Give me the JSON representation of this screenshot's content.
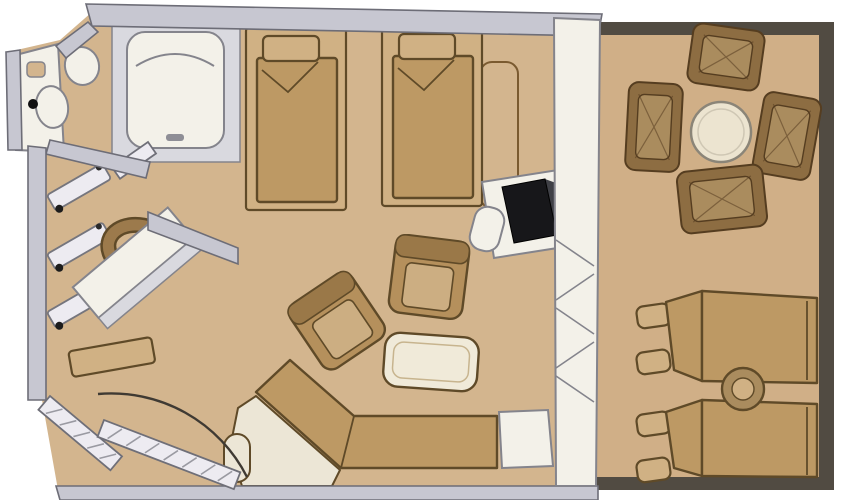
{
  "scene": {
    "type": "floor-plan",
    "title": "Suite stateroom floor plan with private balcony",
    "has_visible_text": false
  },
  "colors": {
    "background": "#ffffff",
    "floor": "#d3b58e",
    "balconyFloor": "#d0af87",
    "balconyEdge": "#514b42",
    "wall": "#c7c7d1",
    "wallEdge": "#6d6d77",
    "fixture": "#f3f1e9",
    "fixtureShade": "#d9d9df",
    "fixtureEdge": "#84848c",
    "furniture": "#bd9964",
    "furnitureLight": "#d0b184",
    "furnitureDark": "#5f4a28",
    "cream": "#ece6d6",
    "wicker": "#8d6d42",
    "wickerLight": "#aa8c5e",
    "wickerDark": "#553d20",
    "tv": "#17171a",
    "tvSide": "#3f4046",
    "doorArc": "#3f3a33",
    "consoleEdge": "#7a5a30",
    "tableTop": "#ece4d0",
    "tableEdge": "#8b8578"
  },
  "rooms": {
    "bathroom": {
      "name": "bathroom",
      "fixtures": [
        "bathtub",
        "toilet",
        "washbasin",
        "vanity-counter",
        "open-door"
      ]
    },
    "dressing_area": {
      "name": "dressing-area",
      "fixtures": [
        "closet-hangers",
        "dressing-table",
        "bench",
        "chair"
      ]
    },
    "bedroom": {
      "name": "bedroom-sitting-area",
      "fixtures": [
        "twin-bed-1",
        "twin-bed-2",
        "console-shelf",
        "tv-cabinet",
        "television",
        "desk-stool",
        "armchair-1",
        "armchair-2",
        "coffee-table",
        "chaise-sofa",
        "sofa-side-table",
        "entry-door"
      ]
    },
    "balcony": {
      "name": "private-balcony",
      "fixtures": [
        "round-dining-table",
        "wicker-chair-top",
        "wicker-chair-left",
        "wicker-chair-right",
        "wicker-chair-bottom",
        "sun-lounger-1",
        "sun-lounger-2",
        "drum-side-table"
      ]
    }
  }
}
